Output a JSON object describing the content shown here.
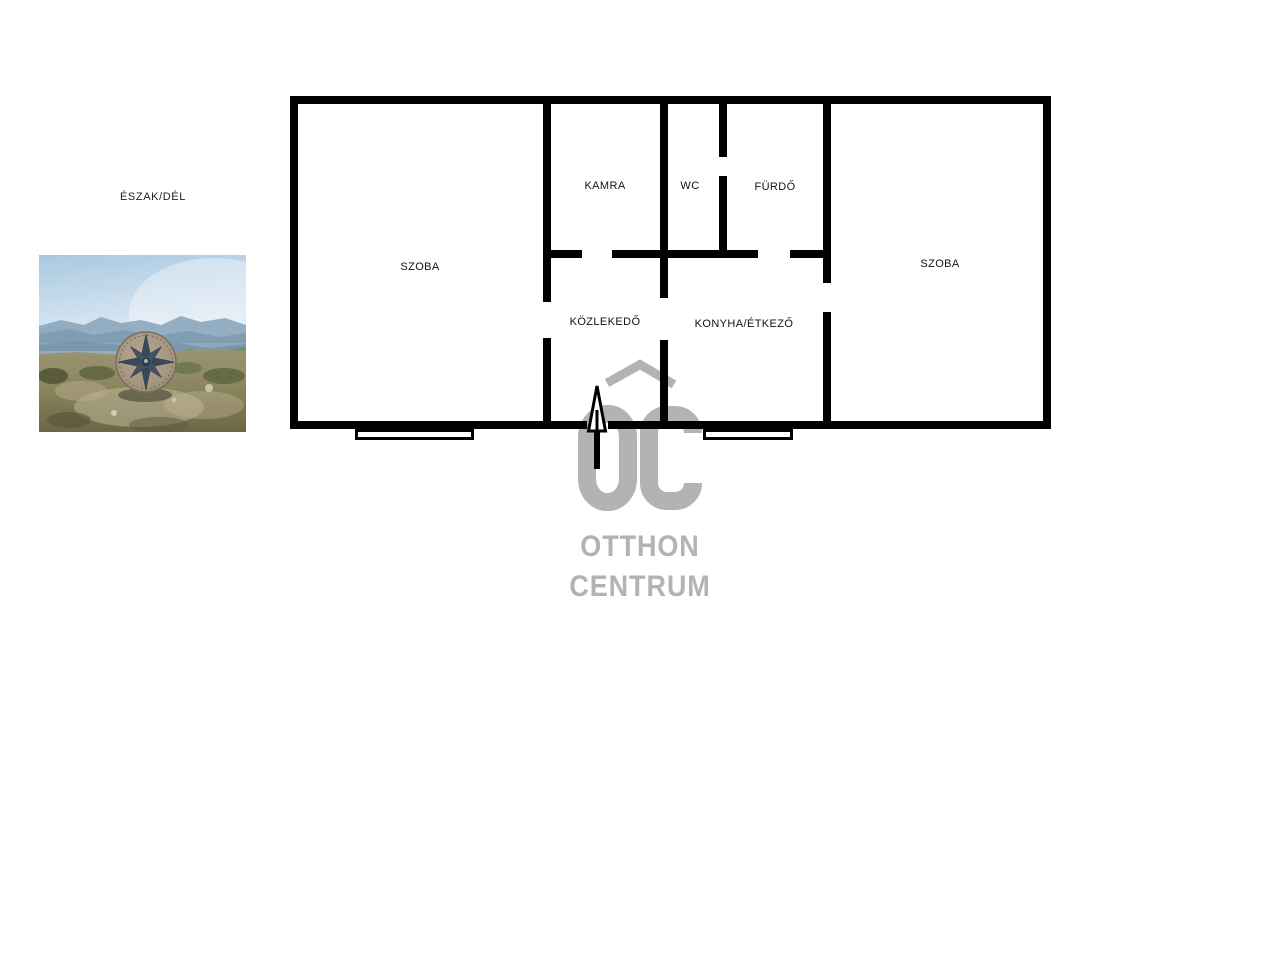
{
  "orientation": {
    "label": "ÉSZAK/DÉL"
  },
  "photo": {
    "name": "compass-landscape-photo"
  },
  "floor_plan": {
    "wall_color": "#000000",
    "rooms": [
      {
        "name": "szoba-left",
        "label": "SZOBA"
      },
      {
        "name": "kamra",
        "label": "KAMRA"
      },
      {
        "name": "wc",
        "label": "WC"
      },
      {
        "name": "furdo",
        "label": "FÜRDŐ"
      },
      {
        "name": "kozlekedo",
        "label": "KÖZLEKEDŐ"
      },
      {
        "name": "konyha-etkezo",
        "label": "KONYHA/ÉTKEZŐ"
      },
      {
        "name": "szoba-right",
        "label": "SZOBA"
      }
    ]
  },
  "logo": {
    "monogram": "OC",
    "line1": "OTTHON",
    "line2": "CENTRUM",
    "color": "#b3b3b3"
  }
}
